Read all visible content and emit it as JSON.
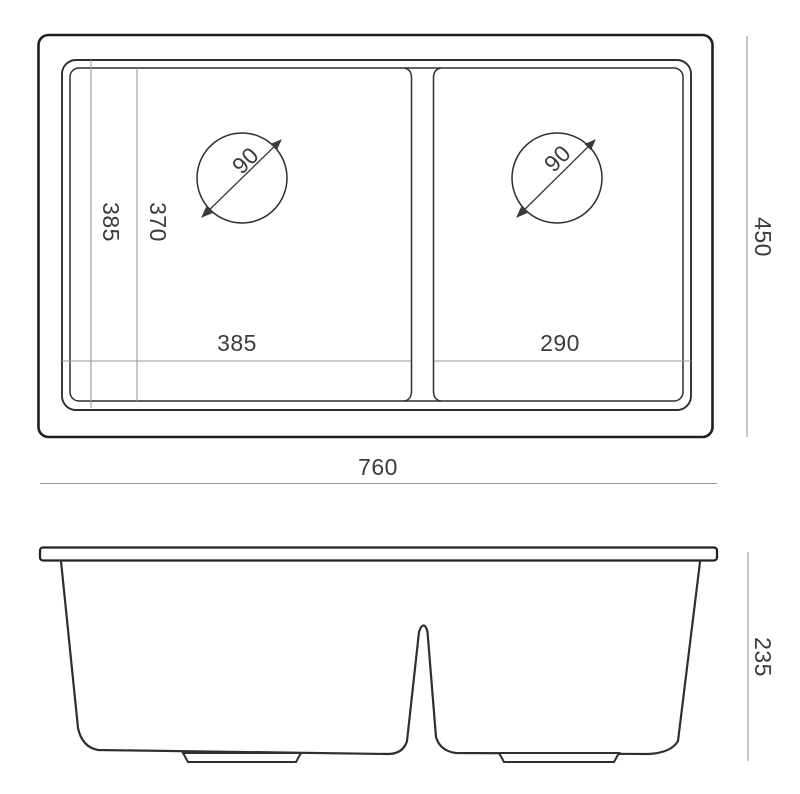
{
  "drawing": {
    "type": "sink-dimension-drawing",
    "colors": {
      "background": "#ffffff",
      "outline": "#2e2e2e",
      "outline_heavy": "#1f1f1f",
      "dimension_line": "#999999",
      "text": "#3b3b3b"
    },
    "top_view": {
      "overall_width": "760",
      "overall_depth": "450",
      "left_bowl_width": "385",
      "right_bowl_width": "290",
      "left_bowl_length_outer": "385",
      "left_bowl_length_inner": "370",
      "left_drain_diameter": "90",
      "right_drain_diameter": "90"
    },
    "front_view": {
      "overall_height": "235"
    }
  }
}
